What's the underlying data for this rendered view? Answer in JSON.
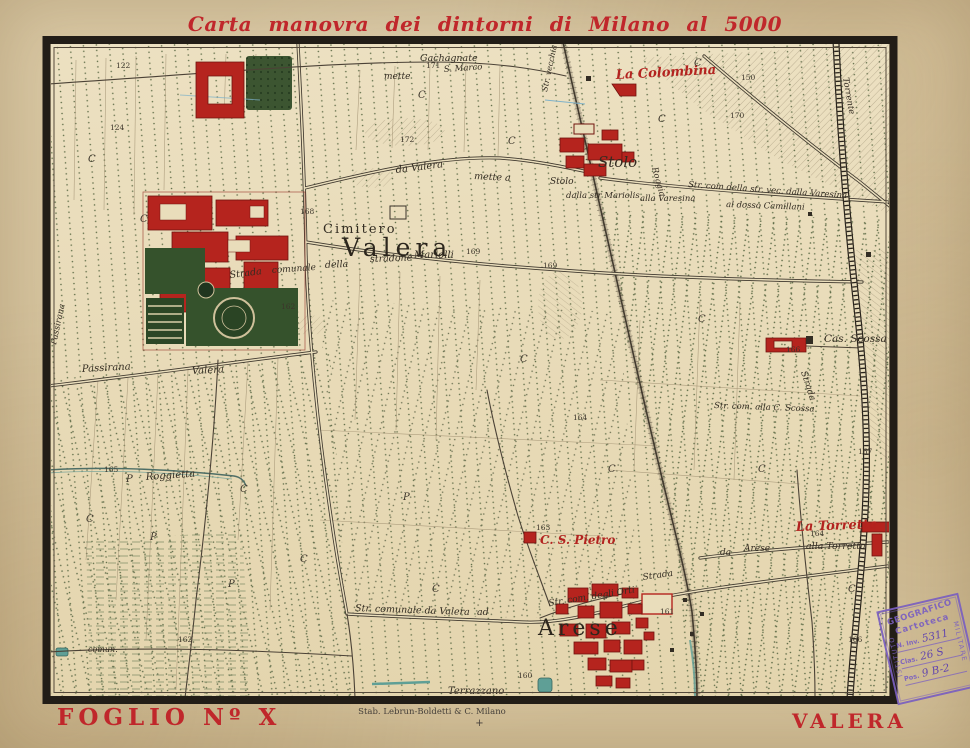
{
  "title": "Carta manovra dei dintorni di Milano al 5000",
  "footer": {
    "folio": "FOGLIO Nº X",
    "publisher": "Stab. Lebrun-Boldetti & C. Milano",
    "registration_mark": "+",
    "sheet_name": "VALERA"
  },
  "stamp": {
    "org_arc": "GEOGRAFICO",
    "org_left": "ISTITUTO",
    "org_right": "MILITARE",
    "section": "Cartoteca",
    "fields": {
      "inv_label": "N. Inv.",
      "inv_value": "5311",
      "clas_label": "Clas.",
      "clas_value": "26 S",
      "pos_label": "Pos.",
      "pos_value": "9 B-2"
    }
  },
  "map": {
    "places": {
      "valera": "Valera",
      "cimitero": "Cimitero",
      "la_colombina": "La Colombina",
      "stolo": "Stolo",
      "stolo_small": "Stolo",
      "cas_scossa": "Cas. Scossa",
      "la_torretta": "La Torretta",
      "alla_torretta": "alla Torretta",
      "c_s_pietro": "C. S. Pietro",
      "arese": "Arese",
      "arese_small": "Arese",
      "da": "da",
      "passirana": "Passirana",
      "valera_road": "Valera",
      "passirana_edge": "Passirana",
      "terrazzano": "Terrazzano"
    },
    "roads": {
      "strada": "Strada",
      "comunale": "comunale",
      "della": "della",
      "stradone": "stradone",
      "mariolli": "Mariolli",
      "da_valera": "da Valera",
      "mette_a": "mette a",
      "mette": "mette",
      "gachagnate": "Gachagnate",
      "s_marco": "S. Marco",
      "varesina": "Str. com della str. vec. dalla Varesina",
      "camillani": "al dosso Camillani",
      "dalla_str_mariolis": "dalla str Mariolis",
      "alla_varesina": "alla Varesina",
      "alla_c_scossa": "Str. com. alla C. Scossa",
      "degli_orti": "Str. com. degli Orti",
      "valera_arese": "Str. comunale da Valera",
      "ad": "ad",
      "roggietta": "Roggietta",
      "roggia": "Roggia",
      "torrente": "Torrente",
      "str_vecchia": "Str. vecchia",
      "comun": "comun."
    },
    "elevations": [
      "169",
      "168",
      "167",
      "166",
      "165",
      "164",
      "163",
      "162",
      "161",
      "160",
      "150",
      "170",
      "171",
      "172",
      "122",
      "124",
      "169",
      "164",
      "162",
      "166"
    ],
    "codes": {
      "c": "C",
      "p": "P"
    }
  },
  "colors": {
    "title_red": "#c0272b",
    "building_red": "#b5241e",
    "garden_green": "#35522c",
    "water_teal": "#5f9f96",
    "stamp_violet": "#7a5fc0",
    "paper": "#d7c5a0",
    "map_ground": "#e9ddbb"
  }
}
